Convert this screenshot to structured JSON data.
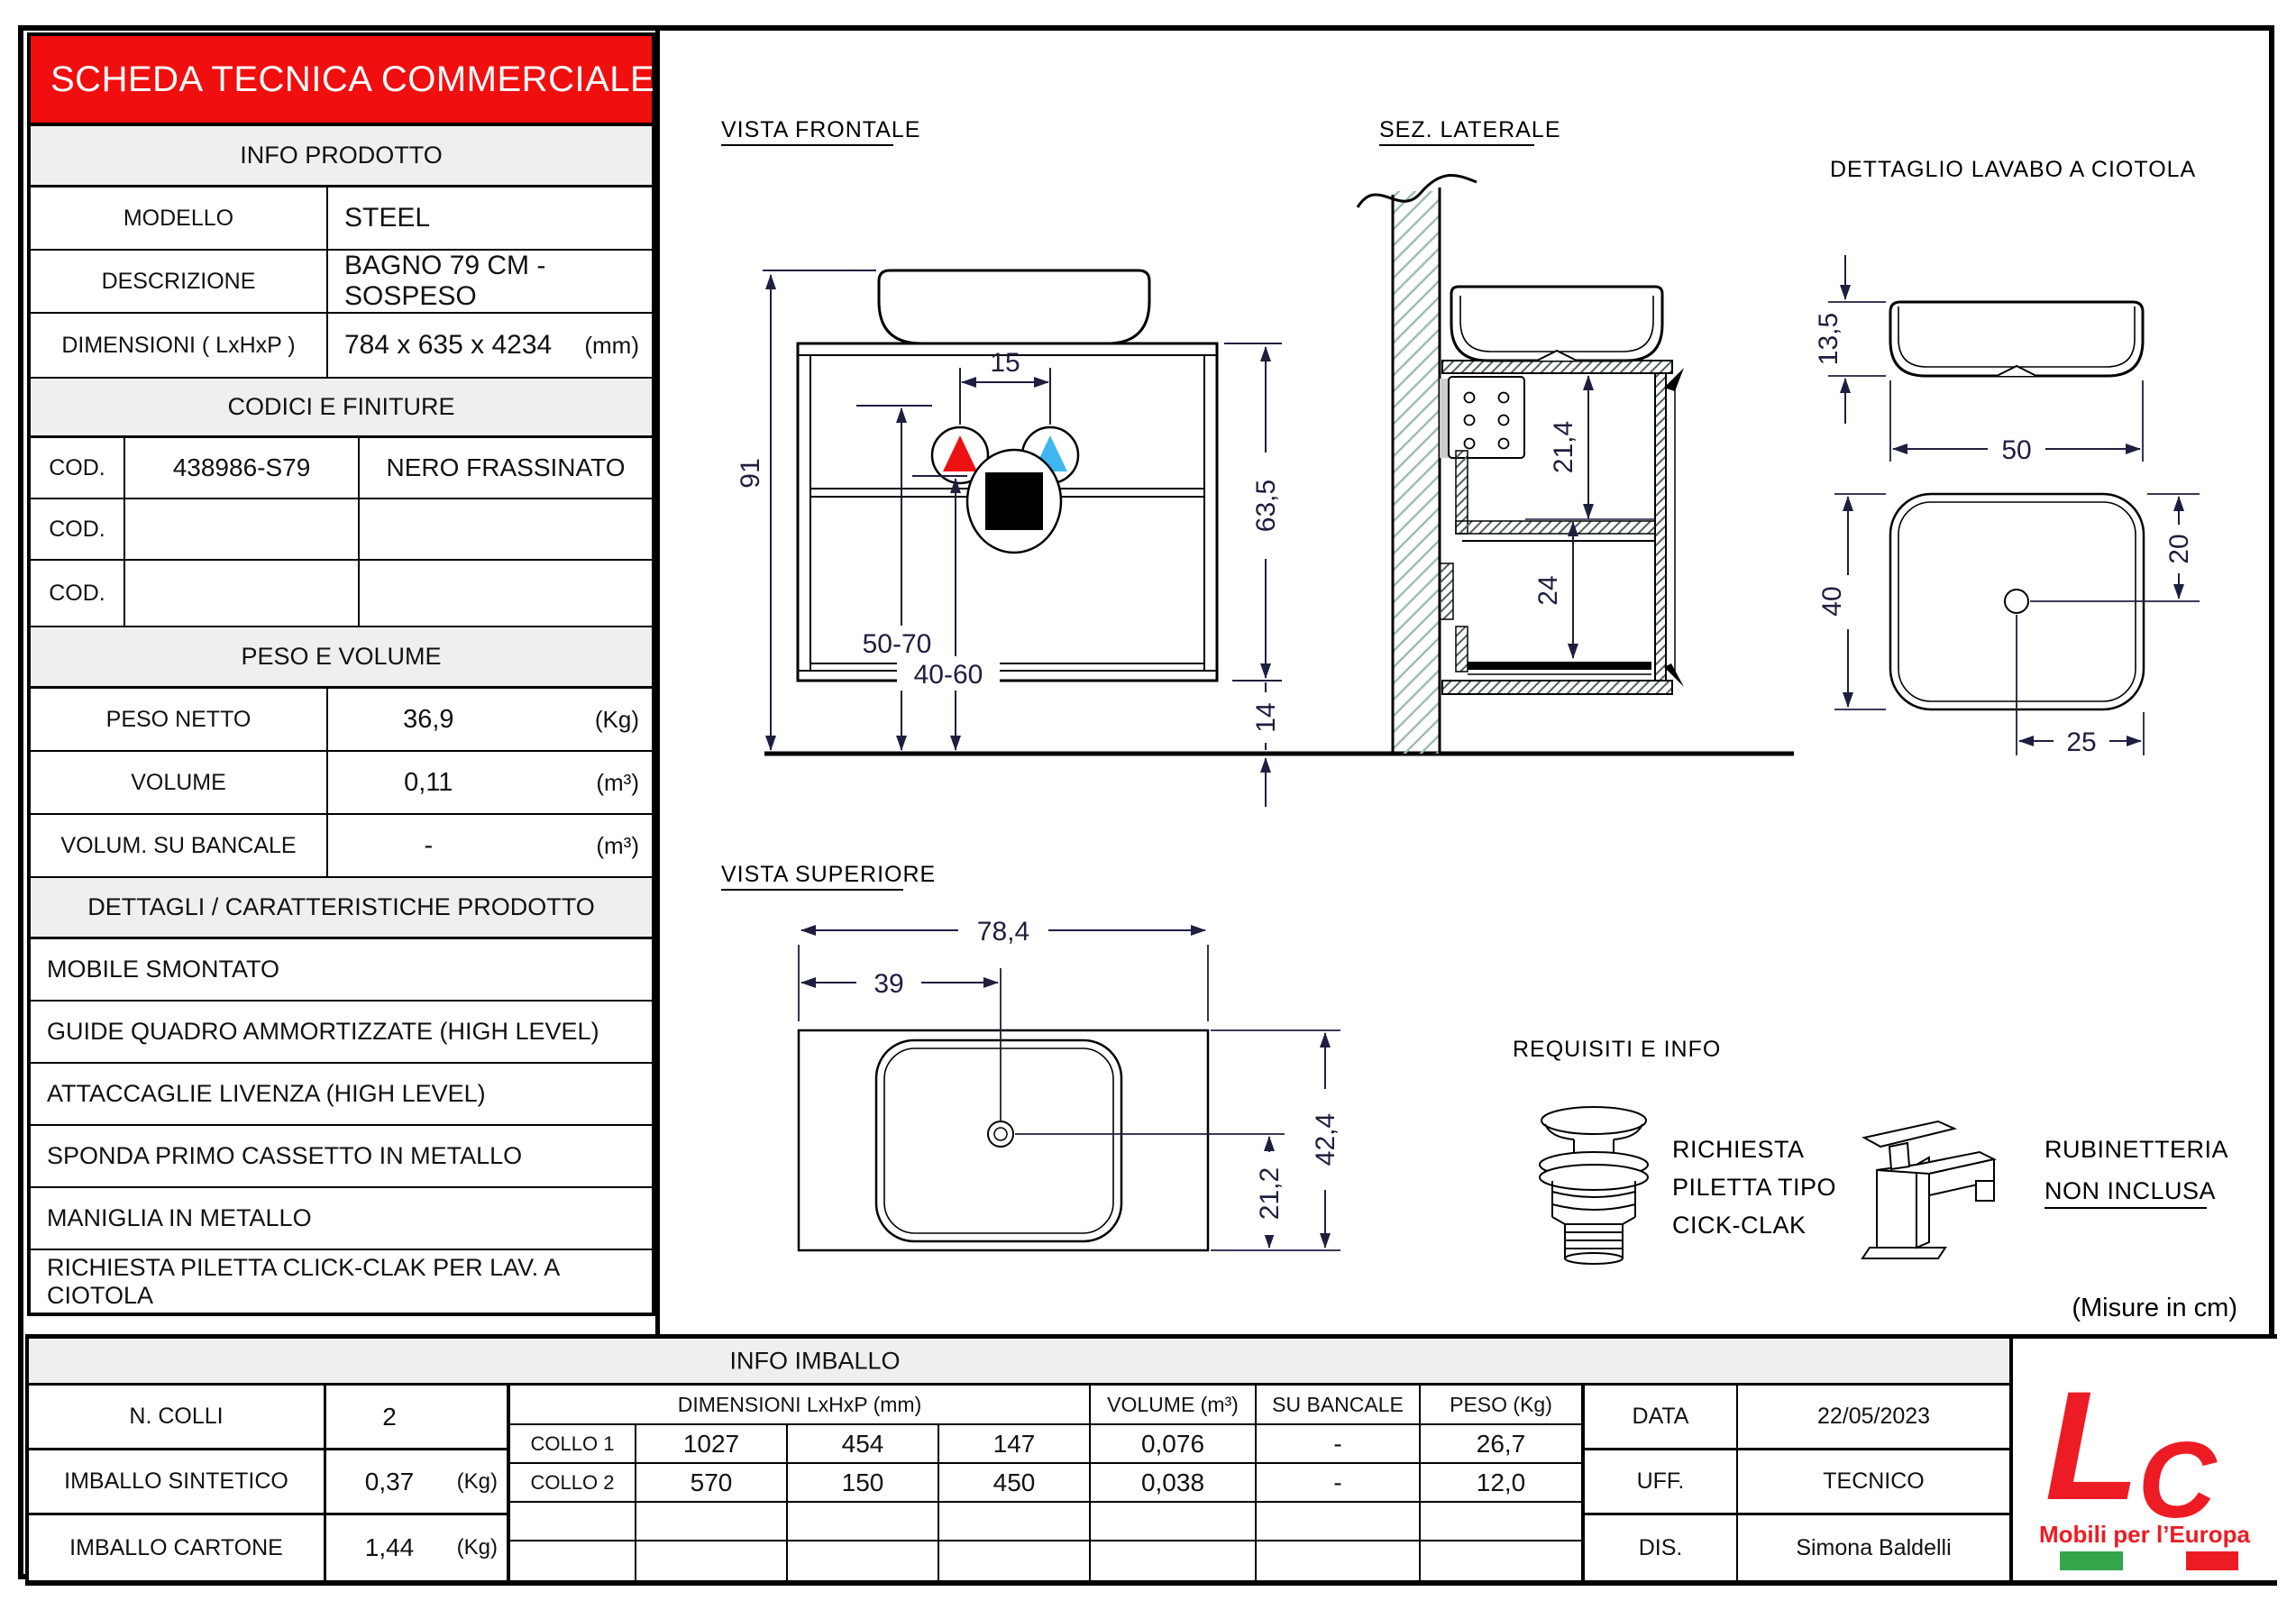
{
  "colors": {
    "banner_red": "#F10E0E",
    "logo_red": "#ED1C24",
    "flag_green": "#33A64C",
    "hot_red": "#EE1111",
    "cold_blue": "#3FB6F0",
    "dim_ink": "#1E1E3F",
    "header_gray": "#EFEFEF"
  },
  "sheet": {
    "title": "SCHEDA TECNICA COMMERCIALE",
    "info": {
      "header": "INFO PRODOTTO",
      "rows": [
        {
          "label": "MODELLO",
          "value": "STEEL"
        },
        {
          "label": "DESCRIZIONE",
          "value": "BAGNO 79 CM - SOSPESO"
        },
        {
          "label": "DIMENSIONI ( LxHxP )",
          "value": "784 x 635 x 4234",
          "unit": "(mm)"
        }
      ]
    },
    "codici": {
      "header": "CODICI E FINITURE",
      "rows": [
        {
          "label": "COD.",
          "code": "438986-S79",
          "finish": "NERO FRASSINATO"
        },
        {
          "label": "COD.",
          "code": "",
          "finish": ""
        },
        {
          "label": "COD.",
          "code": "",
          "finish": ""
        }
      ]
    },
    "peso": {
      "header": "PESO E VOLUME",
      "rows": [
        {
          "label": "PESO NETTO",
          "value": "36,9",
          "unit": "(Kg)"
        },
        {
          "label": "VOLUME",
          "value": "0,11",
          "unit": "(m³)"
        },
        {
          "label": "VOLUM. SU BANCALE",
          "value": "-",
          "unit": "(m³)"
        }
      ]
    },
    "dettagli": {
      "header": "DETTAGLI / CARATTERISTICHE PRODOTTO",
      "items": [
        "MOBILE SMONTATO",
        "GUIDE QUADRO AMMORTIZZATE (HIGH LEVEL)",
        "ATTACCAGLIE LIVENZA (HIGH LEVEL)",
        "SPONDA PRIMO CASSETTO IN METALLO",
        "MANIGLIA IN METALLO",
        "RICHIESTA PILETTA CLICK-CLAK PER LAV. A CIOTOLA"
      ]
    }
  },
  "drawings": {
    "front": {
      "title": "VISTA FRONTALE",
      "d91": "91",
      "d15": "15",
      "d5070": "50-70",
      "d4060": "40-60",
      "d635": "63,5",
      "d14": "14"
    },
    "side": {
      "title": "SEZ. LATERALE",
      "d214": "21,4",
      "d24": "24"
    },
    "detail": {
      "title": "DETTAGLIO LAVABO A CIOTOLA",
      "d135": "13,5",
      "d50": "50",
      "d40": "40",
      "d20": "20",
      "d25": "25"
    },
    "top": {
      "title": "VISTA SUPERIORE",
      "d784": "78,4",
      "d39": "39",
      "d424": "42,4",
      "d212": "21,2"
    },
    "requisiti": {
      "title": "REQUISITI E INFO",
      "drain1": "RICHIESTA",
      "drain2": "PILETTA TIPO",
      "drain3": "CICK-CLAK",
      "tap1": "RUBINETTERIA",
      "tap2": "NON INCLUSA",
      "note": "(Misure in cm)"
    }
  },
  "imballo": {
    "header": "INFO IMBALLO",
    "left": {
      "rows": [
        {
          "label": "N. COLLI",
          "value": "2"
        },
        {
          "label": "IMBALLO SINTETICO",
          "value": "0,37",
          "unit": "(Kg)"
        },
        {
          "label": "IMBALLO CARTONE",
          "value": "1,44",
          "unit": "(Kg)"
        }
      ]
    },
    "table": {
      "dim_header": "DIMENSIONI  LxHxP (mm)",
      "vol_header": "VOLUME (m³)",
      "banc_header": "SU BANCALE",
      "peso_header": "PESO (Kg)",
      "rows": [
        {
          "label": "COLLO 1",
          "l": "1027",
          "h": "454",
          "p": "147",
          "vol": "0,076",
          "banc": "-",
          "peso": "26,7"
        },
        {
          "label": "COLLO 2",
          "l": "570",
          "h": "150",
          "p": "450",
          "vol": "0,038",
          "banc": "-",
          "peso": "12,0"
        }
      ]
    },
    "right": {
      "rows": [
        {
          "label": "DATA",
          "value": "22/05/2023"
        },
        {
          "label": "UFF.",
          "value": "TECNICO"
        },
        {
          "label": "DIS.",
          "value": "Simona Baldelli"
        }
      ]
    }
  },
  "logo": {
    "letter_l": "L",
    "letter_c": "C",
    "tagline": "Mobili per l’Europa"
  }
}
